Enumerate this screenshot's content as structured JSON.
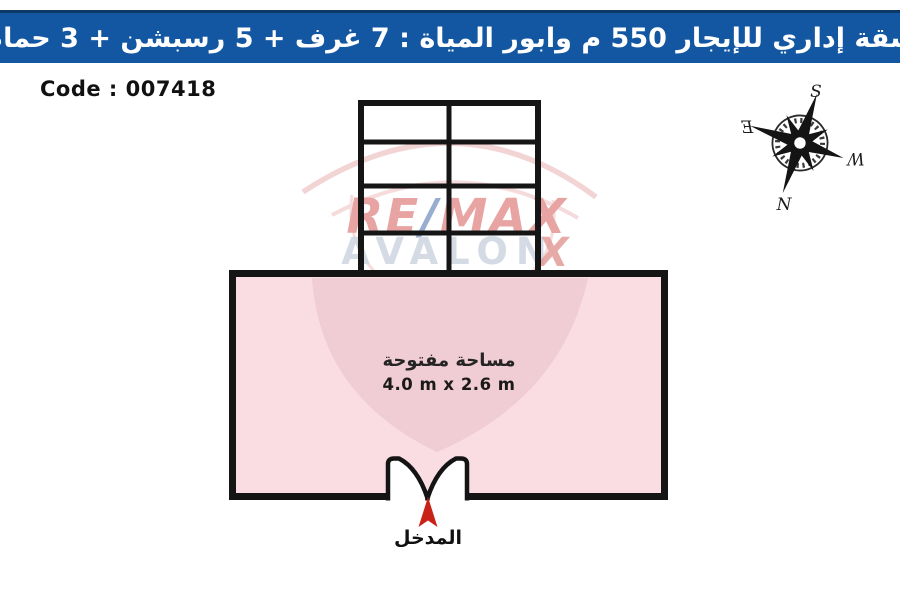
{
  "header": {
    "title": "شقة إداري للإيجار 550 م وابور المياة :  7 غرف + 5 رسبشن + 3 حمام",
    "bg_color": "#1356a2"
  },
  "code": {
    "label": "Code : 007418"
  },
  "compass": {
    "north": "N",
    "south": "S",
    "east": "E",
    "west": "W"
  },
  "watermark": {
    "brand_re": "RE",
    "brand_slash": "/",
    "brand_max": "MAX",
    "brand_sub": "AVALON",
    "brand_x": "X",
    "letter_color": "#e59b98",
    "slash_color": "#8da6cc"
  },
  "floor_plan": {
    "open_area": {
      "label": "مساحة مفتوحة",
      "dimensions": "4.0 m x 2.6 m"
    },
    "entrance": {
      "label": "المدخل"
    },
    "colors": {
      "room_fill": "#fadde2",
      "watermark_fan": "#f0ccd4",
      "wall": "#151515",
      "entrance_arrow": "#c92218"
    }
  }
}
